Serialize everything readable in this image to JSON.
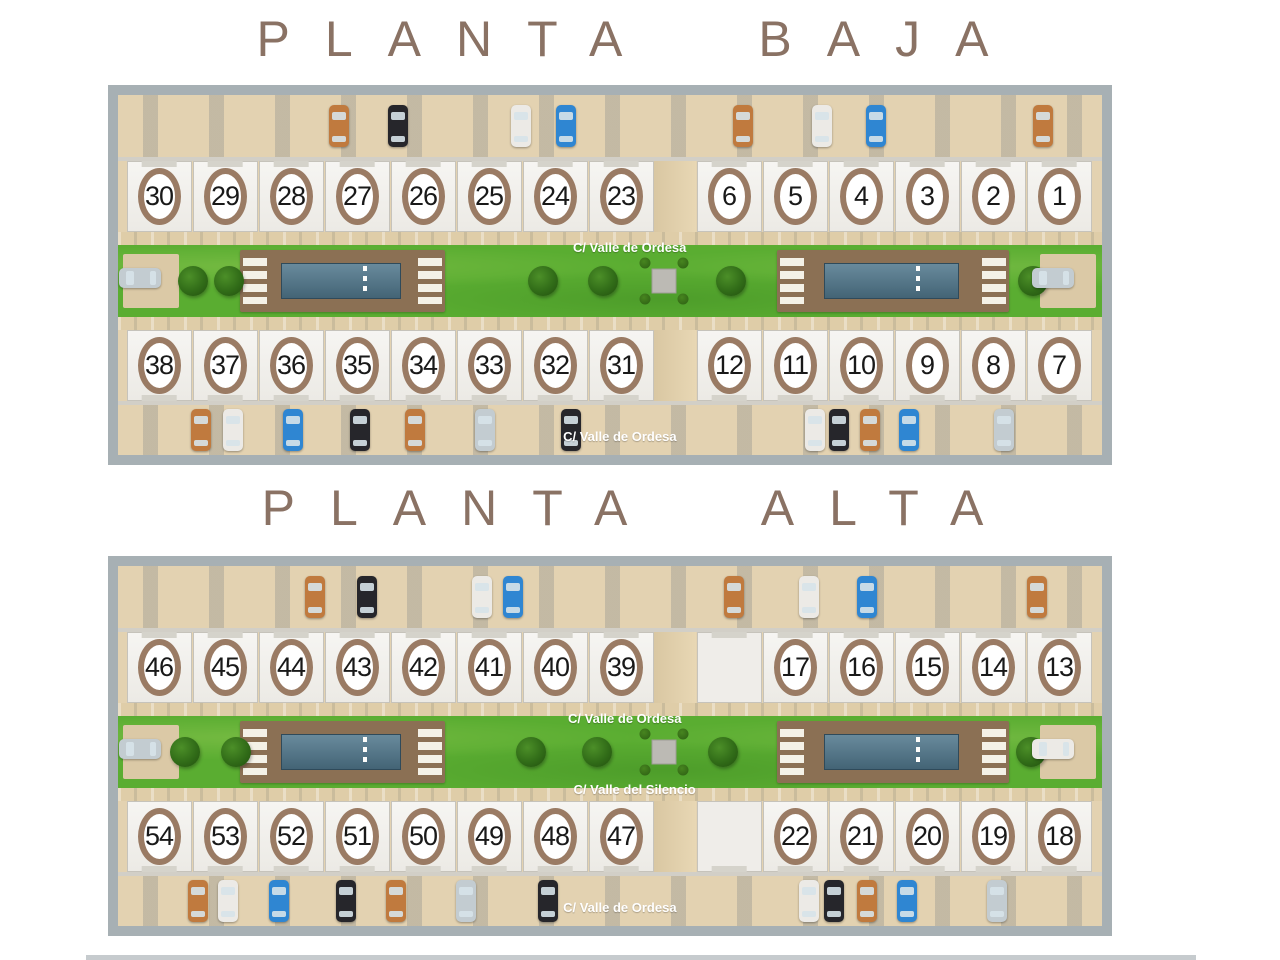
{
  "colors": {
    "title": "#8a7264",
    "ring": "#9a7b64",
    "ground": "#e3d2b1",
    "grass": "#5aad31",
    "deck": "#8b7054",
    "pool": "#50778c",
    "road": "#a7b0b4",
    "label": "#ffffff"
  },
  "car_colors": {
    "orange": "#c07a3e",
    "black": "#26262b",
    "white": "#eceae6",
    "blue": "#2f86d2",
    "silver": "#c3ccd1"
  },
  "sections": [
    {
      "id": "planta-baja",
      "title": "PLANTA BAJA",
      "units": {
        "top_left": [
          "30",
          "29",
          "28",
          "27",
          "26",
          "25",
          "24",
          "23"
        ],
        "top_right": [
          "6",
          "5",
          "4",
          "3",
          "2",
          "1"
        ],
        "bottom_left": [
          "38",
          "37",
          "36",
          "35",
          "34",
          "33",
          "32",
          "31"
        ],
        "bottom_right": [
          "12",
          "11",
          "10",
          "9",
          "8",
          "7"
        ]
      },
      "streets": {
        "center": "C/ Valle de Ordesa",
        "bottom": "C/ Valle de Ordesa"
      },
      "trees": [
        7.6,
        11.3,
        43.2,
        49.3,
        62.3,
        93
      ],
      "cars": {
        "top": [
          {
            "x": 22.5,
            "c": "orange"
          },
          {
            "x": 28.5,
            "c": "black"
          },
          {
            "x": 41,
            "c": "white"
          },
          {
            "x": 45.5,
            "c": "blue"
          },
          {
            "x": 63.5,
            "c": "orange"
          },
          {
            "x": 71.5,
            "c": "white"
          },
          {
            "x": 77,
            "c": "blue"
          },
          {
            "x": 94,
            "c": "orange"
          }
        ],
        "green": [
          {
            "x": 2.2,
            "c": "silver",
            "h": true
          },
          {
            "x": 95,
            "c": "silver",
            "h": true
          }
        ],
        "bottom": [
          {
            "x": 8.4,
            "c": "orange"
          },
          {
            "x": 11.7,
            "c": "white"
          },
          {
            "x": 17.8,
            "c": "blue"
          },
          {
            "x": 24.6,
            "c": "black"
          },
          {
            "x": 30.2,
            "c": "orange"
          },
          {
            "x": 37.3,
            "c": "silver"
          },
          {
            "x": 46,
            "c": "black"
          },
          {
            "x": 70.8,
            "c": "white"
          },
          {
            "x": 73.3,
            "c": "black"
          },
          {
            "x": 76.4,
            "c": "orange"
          },
          {
            "x": 80.4,
            "c": "blue"
          },
          {
            "x": 90,
            "c": "silver"
          }
        ]
      }
    },
    {
      "id": "planta-alta",
      "title": "PLANTA ALTA",
      "units": {
        "top_left": [
          "46",
          "45",
          "44",
          "43",
          "42",
          "41",
          "40",
          "39"
        ],
        "top_right": [
          "",
          "17",
          "16",
          "15",
          "14",
          "13"
        ],
        "bottom_left": [
          "54",
          "53",
          "52",
          "51",
          "50",
          "49",
          "48",
          "47"
        ],
        "bottom_right": [
          "",
          "22",
          "21",
          "20",
          "19",
          "18"
        ]
      },
      "streets": {
        "center": "C/ Valle de Ordesa",
        "silencio": "C/ Valle del Silencio",
        "bottom": "C/ Valle de Ordesa"
      },
      "trees": [
        6.8,
        12,
        42,
        48.7,
        61.5,
        92.8
      ],
      "cars": {
        "top": [
          {
            "x": 20,
            "c": "orange"
          },
          {
            "x": 25.3,
            "c": "black"
          },
          {
            "x": 37,
            "c": "white"
          },
          {
            "x": 40.1,
            "c": "blue"
          },
          {
            "x": 62.6,
            "c": "orange"
          },
          {
            "x": 70.2,
            "c": "white"
          },
          {
            "x": 76.1,
            "c": "blue"
          },
          {
            "x": 93.4,
            "c": "orange"
          }
        ],
        "green": [
          {
            "x": 2.2,
            "c": "silver",
            "h": true
          },
          {
            "x": 95,
            "c": "white",
            "h": true
          }
        ],
        "bottom": [
          {
            "x": 8.1,
            "c": "orange"
          },
          {
            "x": 11.2,
            "c": "white"
          },
          {
            "x": 16.4,
            "c": "blue"
          },
          {
            "x": 23.2,
            "c": "black"
          },
          {
            "x": 28.3,
            "c": "orange"
          },
          {
            "x": 35.4,
            "c": "silver"
          },
          {
            "x": 43.7,
            "c": "black"
          },
          {
            "x": 70.2,
            "c": "white"
          },
          {
            "x": 72.8,
            "c": "black"
          },
          {
            "x": 76.1,
            "c": "orange"
          },
          {
            "x": 80.2,
            "c": "blue"
          },
          {
            "x": 89.3,
            "c": "silver"
          }
        ]
      }
    }
  ]
}
